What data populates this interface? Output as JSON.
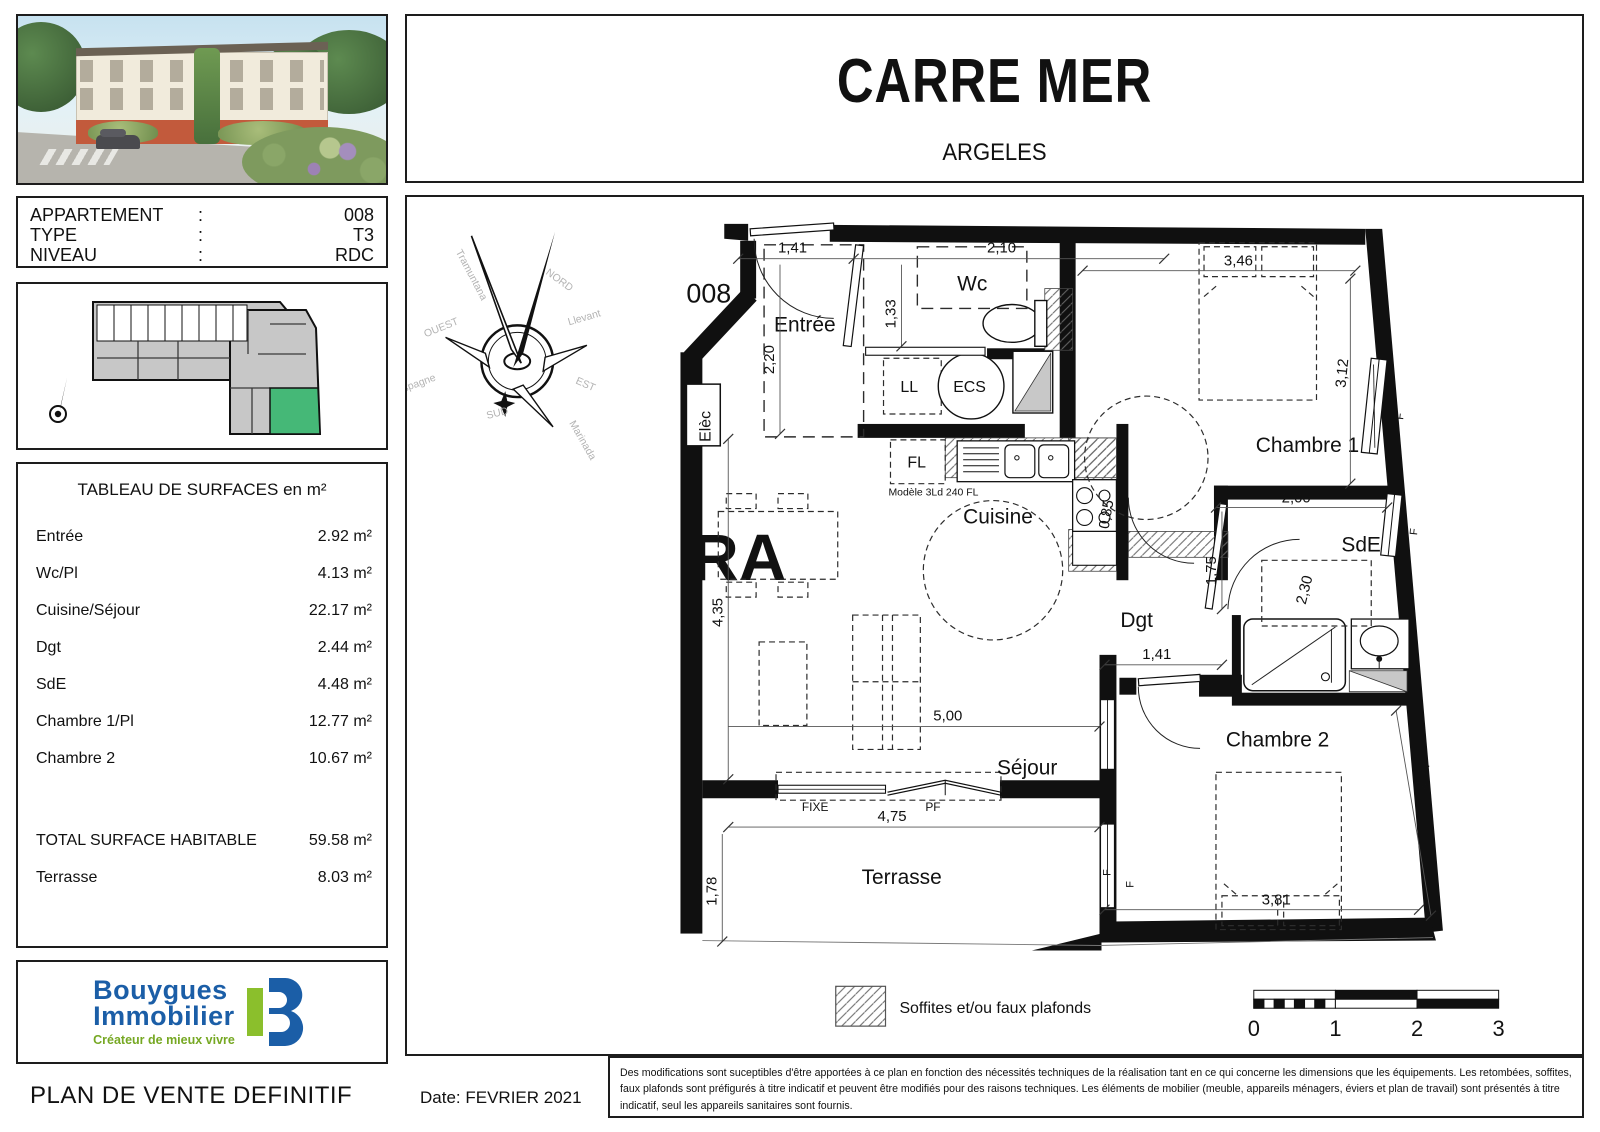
{
  "header": {
    "title": "CARRE MER",
    "subtitle": "ARGELES"
  },
  "info": {
    "rows": [
      {
        "label": "APPARTEMENT",
        "colon": ":",
        "value": "008"
      },
      {
        "label": "TYPE",
        "colon": ":",
        "value": "T3"
      },
      {
        "label": "NIVEAU",
        "colon": ":",
        "value": "RDC"
      }
    ]
  },
  "surfaces": {
    "title": "TABLEAU DE SURFACES en m²",
    "rows": [
      {
        "label": "Entrée",
        "value": "2.92 m²"
      },
      {
        "label": "Wc/Pl",
        "value": "4.13 m²"
      },
      {
        "label": "Cuisine/Séjour",
        "value": "22.17 m²"
      },
      {
        "label": "Dgt",
        "value": "2.44 m²"
      },
      {
        "label": "SdE",
        "value": "4.48 m²"
      },
      {
        "label": "Chambre 1/Pl",
        "value": "12.77 m²"
      },
      {
        "label": "Chambre 2",
        "value": "10.67 m²"
      }
    ],
    "total": {
      "label": "TOTAL SURFACE HABITABLE",
      "value": "59.58 m²"
    },
    "extra": {
      "label": "Terrasse",
      "value": "8.03 m²"
    }
  },
  "logo": {
    "name1": "Bouygues",
    "name2": "Immobilier",
    "tagline": "Créateur de mieux vivre"
  },
  "footer": {
    "doc_title": "PLAN DE VENTE DEFINITIF",
    "date_label": "Date: FEVRIER 2021",
    "disclaimer": "Des modifications sont suceptibles d'être apportées à ce plan en fonction des nécessités techniques de la réalisation tant en ce qui concerne les dimensions que les équipements. Les retombées, soffites, faux plafonds sont préfigurés à titre indicatif et peuvent être modifiés pour des raisons techniques. Les éléments de mobilier (meuble, appareils ménagers, éviers et plan de travail) sont présentés à titre indicatif, seul les appareils sanitaires sont fournis."
  },
  "legend": {
    "soffits": "Soffites et/ou faux plafonds",
    "scale": [
      "0",
      "1",
      "2",
      "3"
    ]
  },
  "compass": {
    "n": "NORD",
    "s": "SUD",
    "e": "EST",
    "o": "OUEST",
    "tramuntana": "Tramuntana",
    "llevant": "Llevant",
    "marinada": "Marinada",
    "vent": "Vent d'Espagne"
  },
  "plan": {
    "unit": "008",
    "rooms": {
      "entree": "Entrée",
      "wc": "Wc",
      "cuisine": "Cuisine",
      "dgt": "Dgt",
      "sde": "SdE",
      "ch1": "Chambre 1",
      "ch2": "Chambre 2",
      "sejour": "Séjour",
      "terrasse": "Terrasse"
    },
    "equip": {
      "ll": "LL",
      "ecs": "ECS",
      "fl": "FL",
      "elec": "Elèc",
      "model": "Modèle 3Ld 240 FL",
      "fixe": "FIXE",
      "pf": "PF",
      "f": "F"
    },
    "dims": {
      "d141a": "1,41",
      "d210": "2,10",
      "d133": "1,33",
      "d220": "2,20",
      "d346": "3,46",
      "d312": "3,12",
      "d200": "2,00",
      "d230": "2,30",
      "d175": "1,75",
      "d141b": "1,41",
      "d085": "0,85",
      "d435": "4,35",
      "d500": "5,00",
      "d475": "4,75",
      "d178": "1,78",
      "d381": "3,81",
      "d277": "2,77"
    },
    "watermark": "RA"
  },
  "colors": {
    "logo_blue": "#1b5ea7",
    "logo_green": "#8bbf2c",
    "unit_green": "#45b877"
  }
}
